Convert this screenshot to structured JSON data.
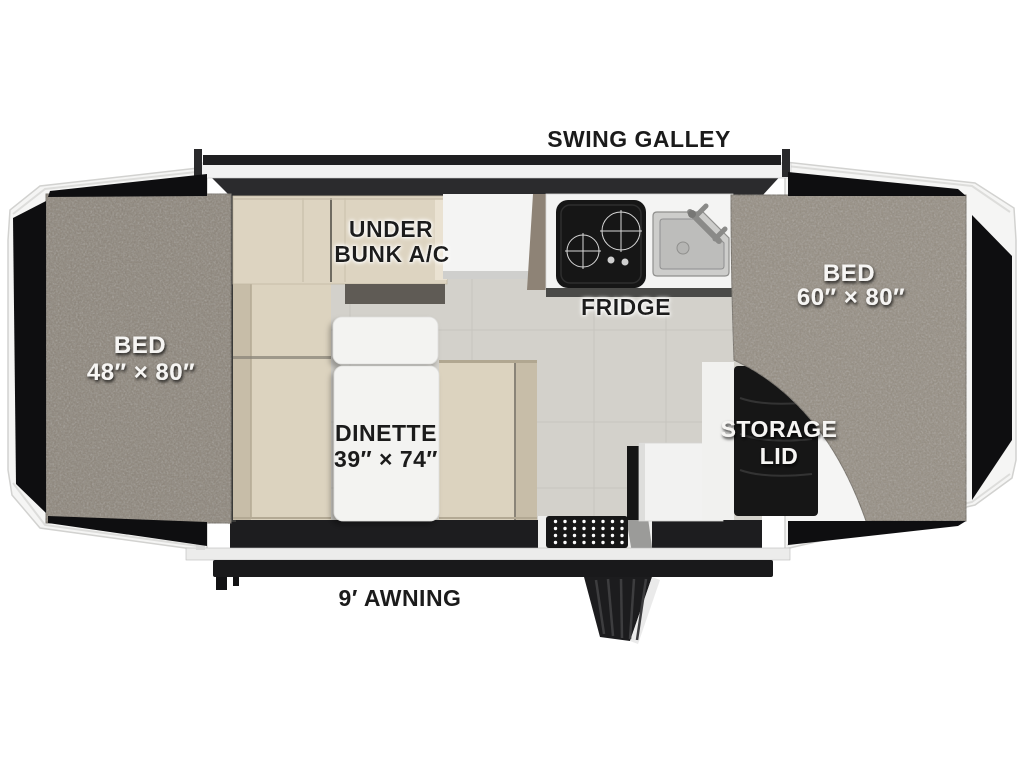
{
  "features": {
    "swing_galley": {
      "label": "SWING GALLEY"
    },
    "under_bunk_ac": {
      "line1": "UNDER",
      "line2": "BUNK A/C"
    },
    "fridge": {
      "label": "FRIDGE"
    },
    "bed_left": {
      "label": "BED",
      "size": "48″ × 80″"
    },
    "bed_right": {
      "label": "BED",
      "size": "60″ × 80″"
    },
    "dinette": {
      "label": "DINETTE",
      "size": "39″ × 74″"
    },
    "storage_lid": {
      "line1": "STORAGE",
      "line2": "LID"
    },
    "awning": {
      "label": "9′ AWNING"
    }
  },
  "colors": {
    "shell_white": "#f5f5f4",
    "wall_dark": "#2b2b2d",
    "panel_black": "#0e0e10",
    "floor": "#d3d1cb",
    "mattress_left": "#8b8377",
    "mattress_right": "#948c80",
    "cushion": "#dcd3bf",
    "cushion_back": "#c7bda8",
    "cabinet": "#ddd4c1",
    "counter": "#f4f4f3",
    "appliance_black": "#161616"
  }
}
